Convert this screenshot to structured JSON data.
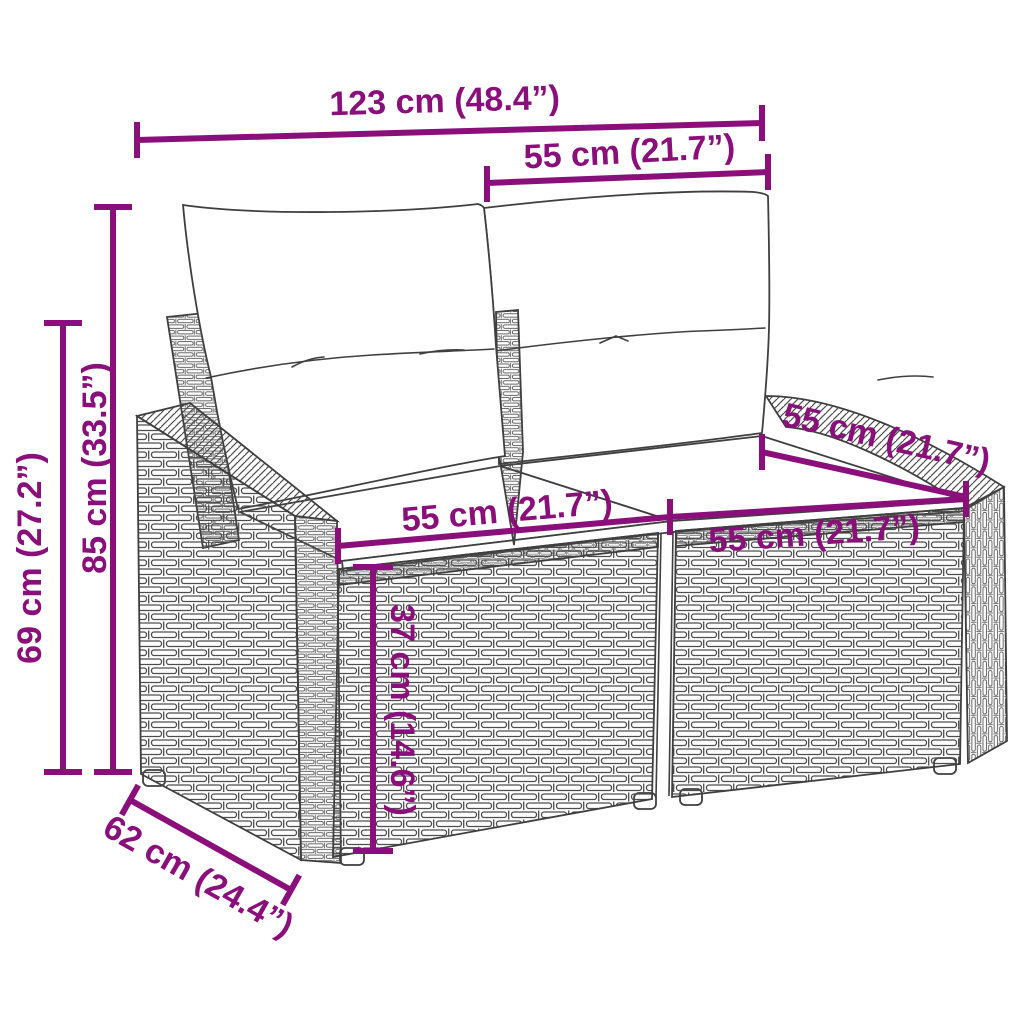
{
  "diagram": {
    "subject": "rattan-two-seater-garden-sofa-with-cushions",
    "accent_color": "#8A0F7A",
    "outline_color": "#3f3f3f",
    "dimensions": [
      {
        "id": "overall-width",
        "label": "123 cm (48.4”)"
      },
      {
        "id": "backrest-section-width",
        "label": "55 cm (21.7”)"
      },
      {
        "id": "overall-height",
        "label": "85 cm (33.5”)"
      },
      {
        "id": "armrest-height",
        "label": "69 cm (27.2”)"
      },
      {
        "id": "left-seat-width",
        "label": "55 cm (21.7”)"
      },
      {
        "id": "right-seat-width",
        "label": "55 cm (21.7”)"
      },
      {
        "id": "seat-depth",
        "label": "55 cm (21.7”)"
      },
      {
        "id": "seat-height",
        "label": "37 cm (14.6”)"
      },
      {
        "id": "overall-depth",
        "label": "62 cm (24.4”)"
      }
    ]
  }
}
